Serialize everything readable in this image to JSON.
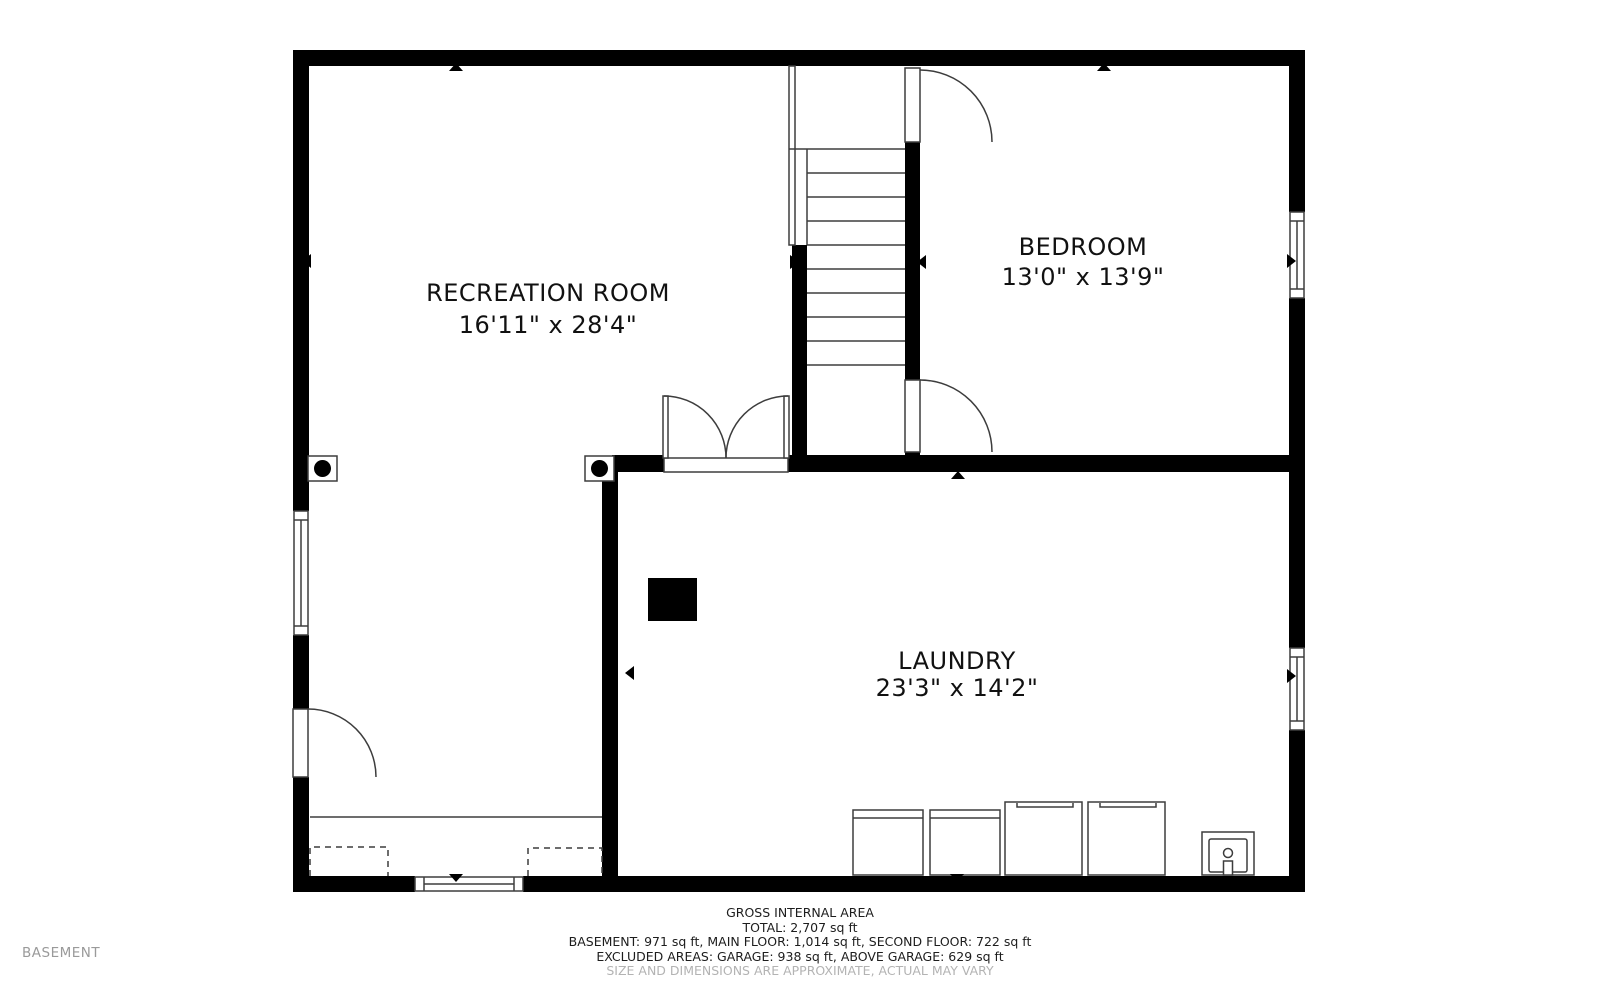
{
  "floor_label": "BASEMENT",
  "rooms": [
    {
      "name": "RECREATION ROOM",
      "dims": "16'11\" x 28'4\""
    },
    {
      "name": "BEDROOM",
      "dims": "13'0\" x 13'9\""
    },
    {
      "name": "LAUNDRY",
      "dims": "23'3\" x 14'2\""
    }
  ],
  "footer": {
    "title": "GROSS INTERNAL AREA",
    "total": "TOTAL: 2,707 sq ft",
    "floors": "BASEMENT: 971 sq ft, MAIN FLOOR: 1,014 sq ft, SECOND FLOOR: 722 sq ft",
    "excluded": "EXCLUDED AREAS: GARAGE: 938 sq ft, ABOVE GARAGE: 629 sq ft",
    "disclaimer": "SIZE AND DIMENSIONS ARE APPROXIMATE, ACTUAL MAY VARY"
  },
  "colors": {
    "wall": "#000000",
    "thin_line": "#3d3d3d",
    "label_text": "#111111",
    "muted_text": "#9a9a9a",
    "background": "#ffffff"
  }
}
